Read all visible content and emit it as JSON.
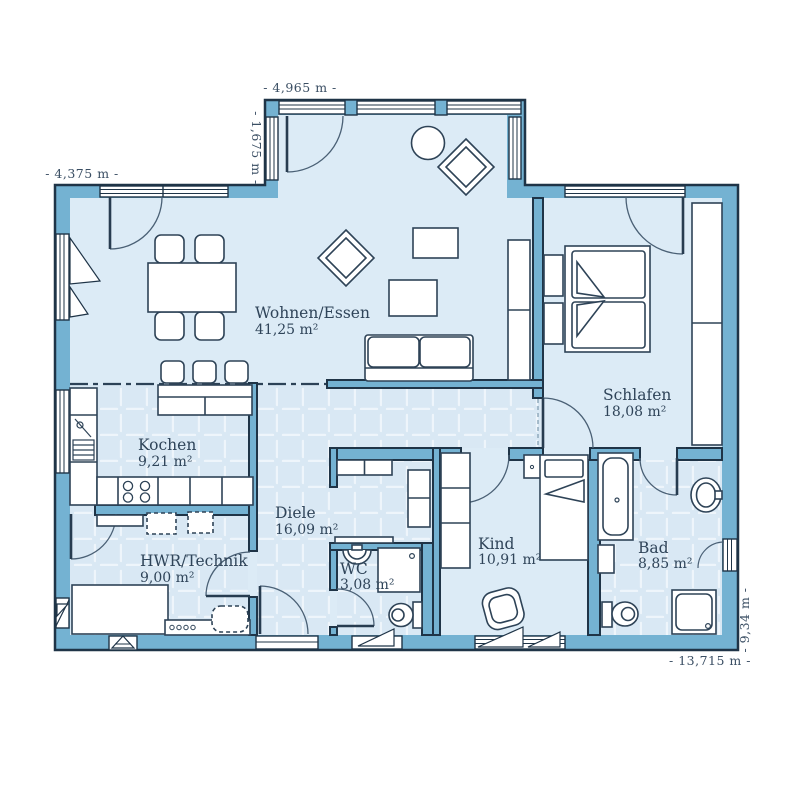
{
  "plan": {
    "title": "bungalow-floor-plan",
    "rooms": [
      {
        "id": "wohnen",
        "name": "Wohnen/Essen",
        "area": "41,25 m²"
      },
      {
        "id": "schlafen",
        "name": "Schlafen",
        "area": "18,08 m²"
      },
      {
        "id": "kochen",
        "name": "Kochen",
        "area": "9,21 m²"
      },
      {
        "id": "diele",
        "name": "Diele",
        "area": "16,09 m²"
      },
      {
        "id": "hwr",
        "name": "HWR/Technik",
        "area": "9,00 m²"
      },
      {
        "id": "wc",
        "name": "WC",
        "area": "3,08 m²"
      },
      {
        "id": "kind",
        "name": "Kind",
        "area": "10,91 m²"
      },
      {
        "id": "bad",
        "name": "Bad",
        "area": "8,85 m²"
      }
    ],
    "dimensions": {
      "top": "- 4,965 m -",
      "bay_left": "- 1,675 m -",
      "left": "- 4,375 m -",
      "bottom": "- 13,715 m -",
      "right": "- 9,34 m -"
    },
    "colors": {
      "wall": "#74b2d2",
      "floor": "#dcebf6",
      "tile_floor": "#d9e8f4",
      "tile_grout": "#eef5fb",
      "outline": "#1f3447",
      "furniture_outline": "#2e4357",
      "label_text": "#2f4459",
      "dimension_text": "#3a4e63"
    }
  }
}
